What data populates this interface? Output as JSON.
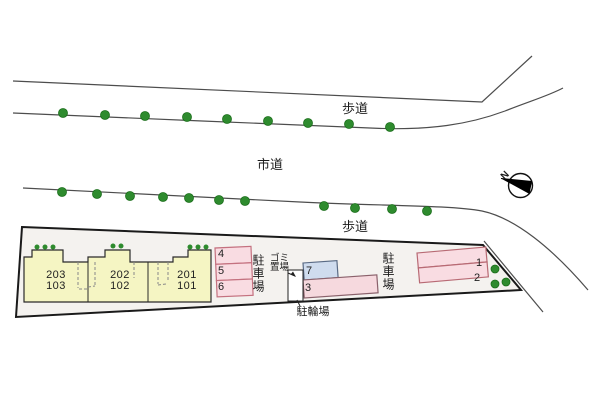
{
  "site_plan": {
    "road_labels": {
      "sidewalk_top": "歩道",
      "city_road": "市道",
      "sidewalk_bottom": "歩道"
    },
    "area_labels": {
      "parking_left": "駐車場",
      "parking_right": "駐車場",
      "garbage_line1": "ゴミ",
      "garbage_line2": "置場",
      "bicycle_parking": "駐輪場"
    },
    "compass": {
      "north": "N"
    },
    "building": {
      "units": [
        {
          "upper": "203",
          "lower": "103"
        },
        {
          "upper": "202",
          "lower": "102"
        },
        {
          "upper": "201",
          "lower": "101"
        }
      ]
    },
    "parking_stalls": {
      "s1": "1",
      "s2": "2",
      "s3": "3",
      "s4": "4",
      "s5": "5",
      "s6": "6",
      "s7": "7"
    },
    "colors": {
      "tree_green": "#2e8b2e",
      "tree_border": "#1a6e1a",
      "building_fill": "#f5f5c3",
      "stall_pink": "#f9dce2",
      "stall_pink_border": "#c4717f",
      "stall_blue": "#cfdcee",
      "stall_blue_border": "#5a6b85",
      "site_fill": "#f4f2ef",
      "road_line": "#4d4d4d",
      "boundary": "#1a1a1a"
    }
  }
}
